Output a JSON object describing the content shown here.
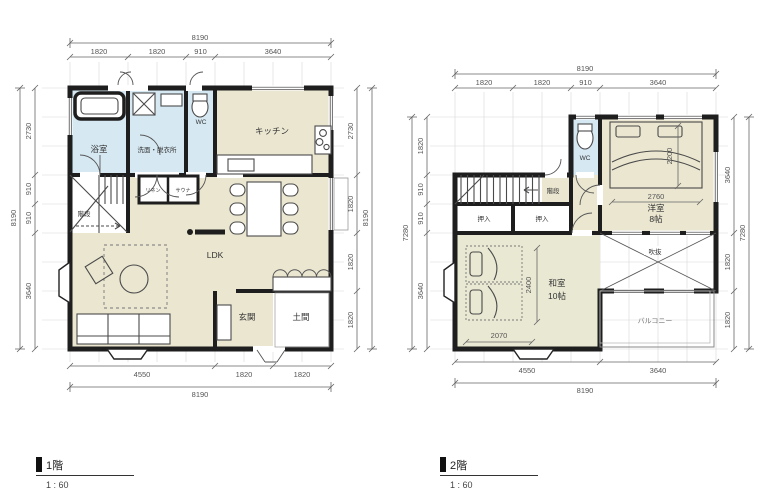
{
  "floor1": {
    "legend": {
      "label": "1階",
      "scale": "1 : 60"
    },
    "rooms": {
      "bath": "浴室",
      "washroom": "洗面・脱衣所",
      "wc": "WC",
      "kitchen": "キッチン",
      "stairs": "階段",
      "linen": "リネン",
      "sauna": "サウナ",
      "ldk": "LDK",
      "entrance": "玄関",
      "doma": "土間"
    },
    "dims": {
      "top_total": "8190",
      "top_segs": [
        "1820",
        "1820",
        "910",
        "3640"
      ],
      "left_total": "8190",
      "left_segs": [
        "2730",
        "910",
        "910",
        "3640"
      ],
      "right_total": "8190",
      "right_segs": [
        "2730",
        "1820",
        "1820",
        "1820"
      ],
      "bottom_total": "8190",
      "bottom_segs": [
        "4550",
        "1820",
        "1820"
      ]
    }
  },
  "floor2": {
    "legend": {
      "label": "2階",
      "scale": "1 : 60"
    },
    "rooms": {
      "wc": "WC",
      "stairs": "階段",
      "closet1": "押入",
      "closet2": "押入",
      "western_room": "洋室",
      "western_room_size": "8帖",
      "japanese_room": "和室",
      "japanese_room_size": "10帖",
      "void": "吹抜",
      "balcony": "バルコニー"
    },
    "dims": {
      "top_total": "8190",
      "top_segs": [
        "1820",
        "1820",
        "910",
        "3640"
      ],
      "left_total": "7280",
      "left_segs": [
        "1820",
        "910",
        "910",
        "3640"
      ],
      "right_total": "7280",
      "right_segs": [
        "3640",
        "1820",
        "1820"
      ],
      "bottom_total": "8190",
      "bottom_segs": [
        "4550",
        "3640"
      ],
      "bed_length": "2200",
      "bed_width": "2760",
      "futon_length": "2400",
      "futon_width": "2070"
    }
  },
  "colors": {
    "wall": "#1e1e1e",
    "floor": "#eae6d0",
    "tatami": "#e9e8d3",
    "wet_area": "#d6e9f3",
    "grid": "#d8d8d8",
    "dim_text": "#555555"
  }
}
